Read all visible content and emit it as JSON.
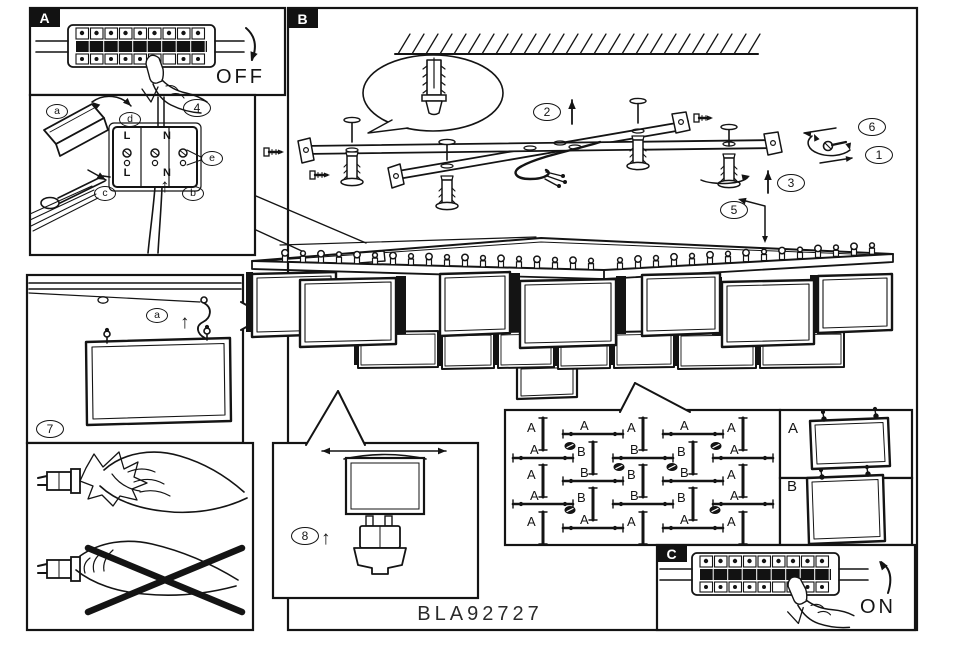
{
  "document": {
    "code": "BLA92727"
  },
  "panel_a": {
    "tab": "A",
    "state": "OFF"
  },
  "panel_b": {
    "tab": "B"
  },
  "panel_c": {
    "tab": "C",
    "state": "ON"
  },
  "panel_4": {
    "step": "4",
    "callouts": {
      "a": "a",
      "b": "b",
      "c": "c",
      "d": "d",
      "e": "e"
    },
    "terminals": {
      "tl": "L",
      "tn": "N",
      "bl": "L",
      "bn": "N"
    }
  },
  "panel_7": {
    "step": "7",
    "callout_a": "a"
  },
  "panel_8": {
    "step": "8"
  },
  "main_steps": {
    "s1": "1",
    "s2": "2",
    "s3": "3",
    "s5": "5",
    "s6": "6"
  },
  "shade_panels": {
    "a_label": "A",
    "b_label": "B"
  },
  "layout_map": {
    "grid": [
      [
        "A",
        "A",
        "A",
        "A",
        "A"
      ],
      [
        "A",
        "B",
        "B",
        "B",
        "A"
      ],
      [
        "A",
        "B",
        "B",
        "B",
        "A"
      ],
      [
        "A",
        "B",
        "B",
        "B",
        "A"
      ],
      [
        "A",
        "A",
        "A",
        "A",
        "A"
      ]
    ]
  },
  "icons": {
    "up_arrow": "↑"
  },
  "colors": {
    "ink": "#141414",
    "paper": "#ffffff"
  }
}
